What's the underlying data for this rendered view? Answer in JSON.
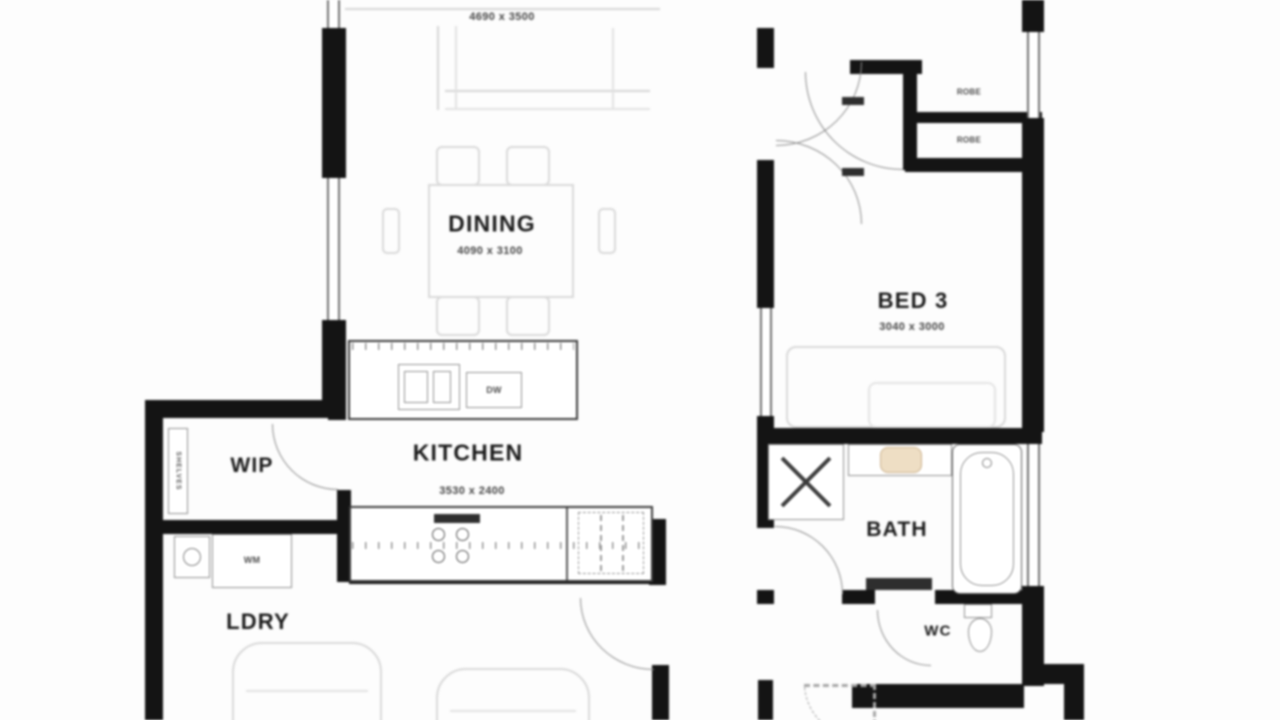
{
  "plan": {
    "living": {
      "dim": "4690 x 3500"
    },
    "dining": {
      "label": "DINING",
      "dim": "4090 x 3100"
    },
    "kitchen": {
      "label": "KITCHEN",
      "dim": "3530 x 2400"
    },
    "wip": {
      "label": "WIP"
    },
    "ldry": {
      "label": "LDRY"
    },
    "bed3": {
      "label": "BED 3",
      "dim": "3040 x 3000"
    },
    "bath": {
      "label": "BATH"
    },
    "wc": {
      "label": "WC"
    },
    "fixtures": {
      "wm": "WM",
      "dw": "DW",
      "robe_top": "ROBE",
      "robe_bottom": "ROBE",
      "shelves": "SHELVES"
    },
    "colors": {
      "wall": "#161616",
      "fixture_line": "#5c5c5c",
      "faint_furniture": "#d7d7d7",
      "vanity_basin": "#ecdcc3",
      "background": "#fdfdfd"
    }
  }
}
